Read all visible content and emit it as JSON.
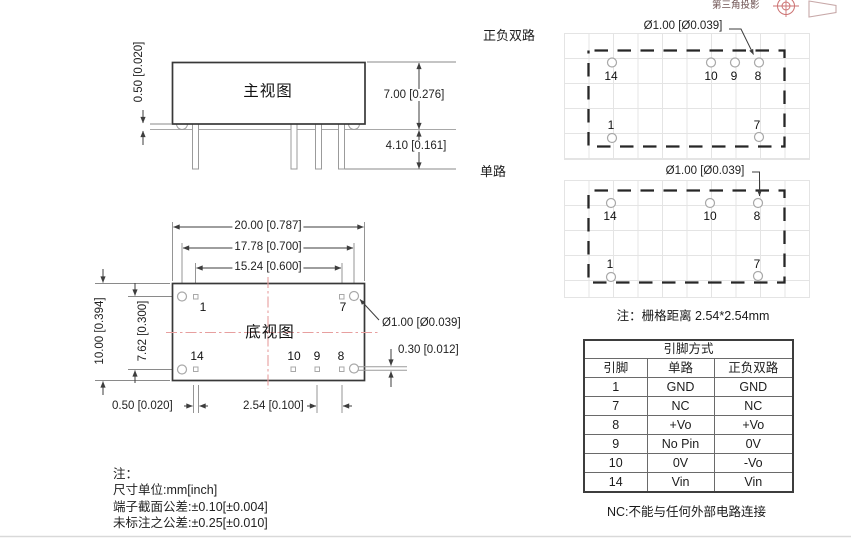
{
  "projection": {
    "label": "第三角投影"
  },
  "front_view": {
    "title": "主视图",
    "dims": {
      "standoff": "0.50 [0.020]",
      "body_height": "7.00 [0.276]",
      "pin_length": "4.10 [0.161]"
    }
  },
  "dual_layout": {
    "label": "正负双路",
    "hole_dia": "Ø1.00 [Ø0.039]",
    "pins": {
      "p14": "14",
      "p10": "10",
      "p9": "9",
      "p8": "8",
      "p1": "1",
      "p7": "7"
    }
  },
  "single_layout": {
    "label": "单路",
    "hole_dia": "Ø1.00 [Ø0.039]",
    "pins": {
      "p14": "14",
      "p10": "10",
      "p8": "8",
      "p1": "1",
      "p7": "7"
    }
  },
  "grid_note": "注：栅格距离 2.54*2.54mm",
  "bottom_view": {
    "title": "底视图",
    "pins": {
      "p1": "1",
      "p7": "7",
      "p14": "14",
      "p10": "10",
      "p9": "9",
      "p8": "8"
    },
    "dims": {
      "body_width": "20.00 [0.787]",
      "standoff_span": "17.78 [0.700]",
      "pin_span": "15.24 [0.600]",
      "body_depth": "10.00 [0.394]",
      "row_span": "7.62 [0.300]",
      "edge_offset": "0.50 [0.020]",
      "pin_pitch": "2.54 [0.100]",
      "hole_dia": "Ø1.00 [Ø0.039]",
      "pin_thickness": "0.30 [0.012]"
    }
  },
  "pin_table": {
    "title": "引脚方式",
    "columns": [
      "引脚",
      "单路",
      "正负双路"
    ],
    "rows": [
      [
        "1",
        "GND",
        "GND"
      ],
      [
        "7",
        "NC",
        "NC"
      ],
      [
        "8",
        "+Vo",
        "+Vo"
      ],
      [
        "9",
        "No Pin",
        "0V"
      ],
      [
        "10",
        "0V",
        "-Vo"
      ],
      [
        "14",
        "Vin",
        "Vin"
      ]
    ],
    "note": "NC:不能与任何外部电路连接"
  },
  "notes": {
    "title": "注：",
    "lines": [
      "尺寸单位:mm[inch]",
      "端子截面公差:±0.10[±0.004]",
      "未标注之公差:±0.25[±0.010]"
    ]
  },
  "colors": {
    "line_dark": "#333333",
    "line_gray": "#999999",
    "centerline_red": "#e79f9f",
    "projection_red": "#cc7272",
    "grid_gray": "#e4e4e4"
  }
}
